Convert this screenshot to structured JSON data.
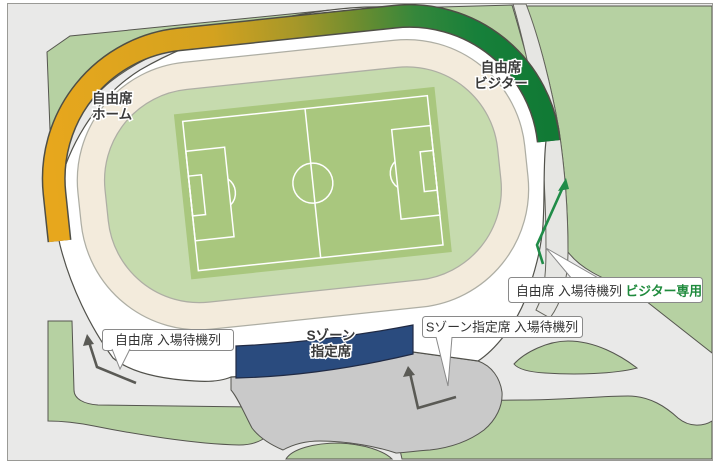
{
  "map_title": "stadium-access-map",
  "frame": {
    "background": "#e9e9e8",
    "border": "#9a9a96"
  },
  "stadium": {
    "home_section": {
      "line1": "自由席",
      "line2": "ホーム",
      "color": "#e7a81e"
    },
    "visitor_section": {
      "line1": "自由席",
      "line2": "ビジター",
      "color": "#17803a"
    },
    "s_zone_section": {
      "line1": "Sゾーン",
      "line2": "指定席",
      "color": "#2a4b7e"
    }
  },
  "callouts": {
    "free_queue": {
      "text": "自由席 入場待機列"
    },
    "s_zone_queue": {
      "text": "Sゾーン指定席 入場待機列"
    },
    "visitor_queue": {
      "text": "自由席 入場待機列 ",
      "suffix": "ビジター専用",
      "suffix_color": "#1e8a3c"
    }
  },
  "palette": {
    "park_green": "#b6d1a2",
    "plaza_gray": "#c9c9c9",
    "road_gray": "#e6e6e3",
    "stand_cream": "#f3ebdc",
    "infield_green": "#c6dbae",
    "pitch_green": "#a9c77e",
    "band_gradient": [
      "#e7a71d",
      "#a59729",
      "#117a35"
    ],
    "queue_arrow": "#5a5a55",
    "visitor_arrow": "#208c48"
  }
}
